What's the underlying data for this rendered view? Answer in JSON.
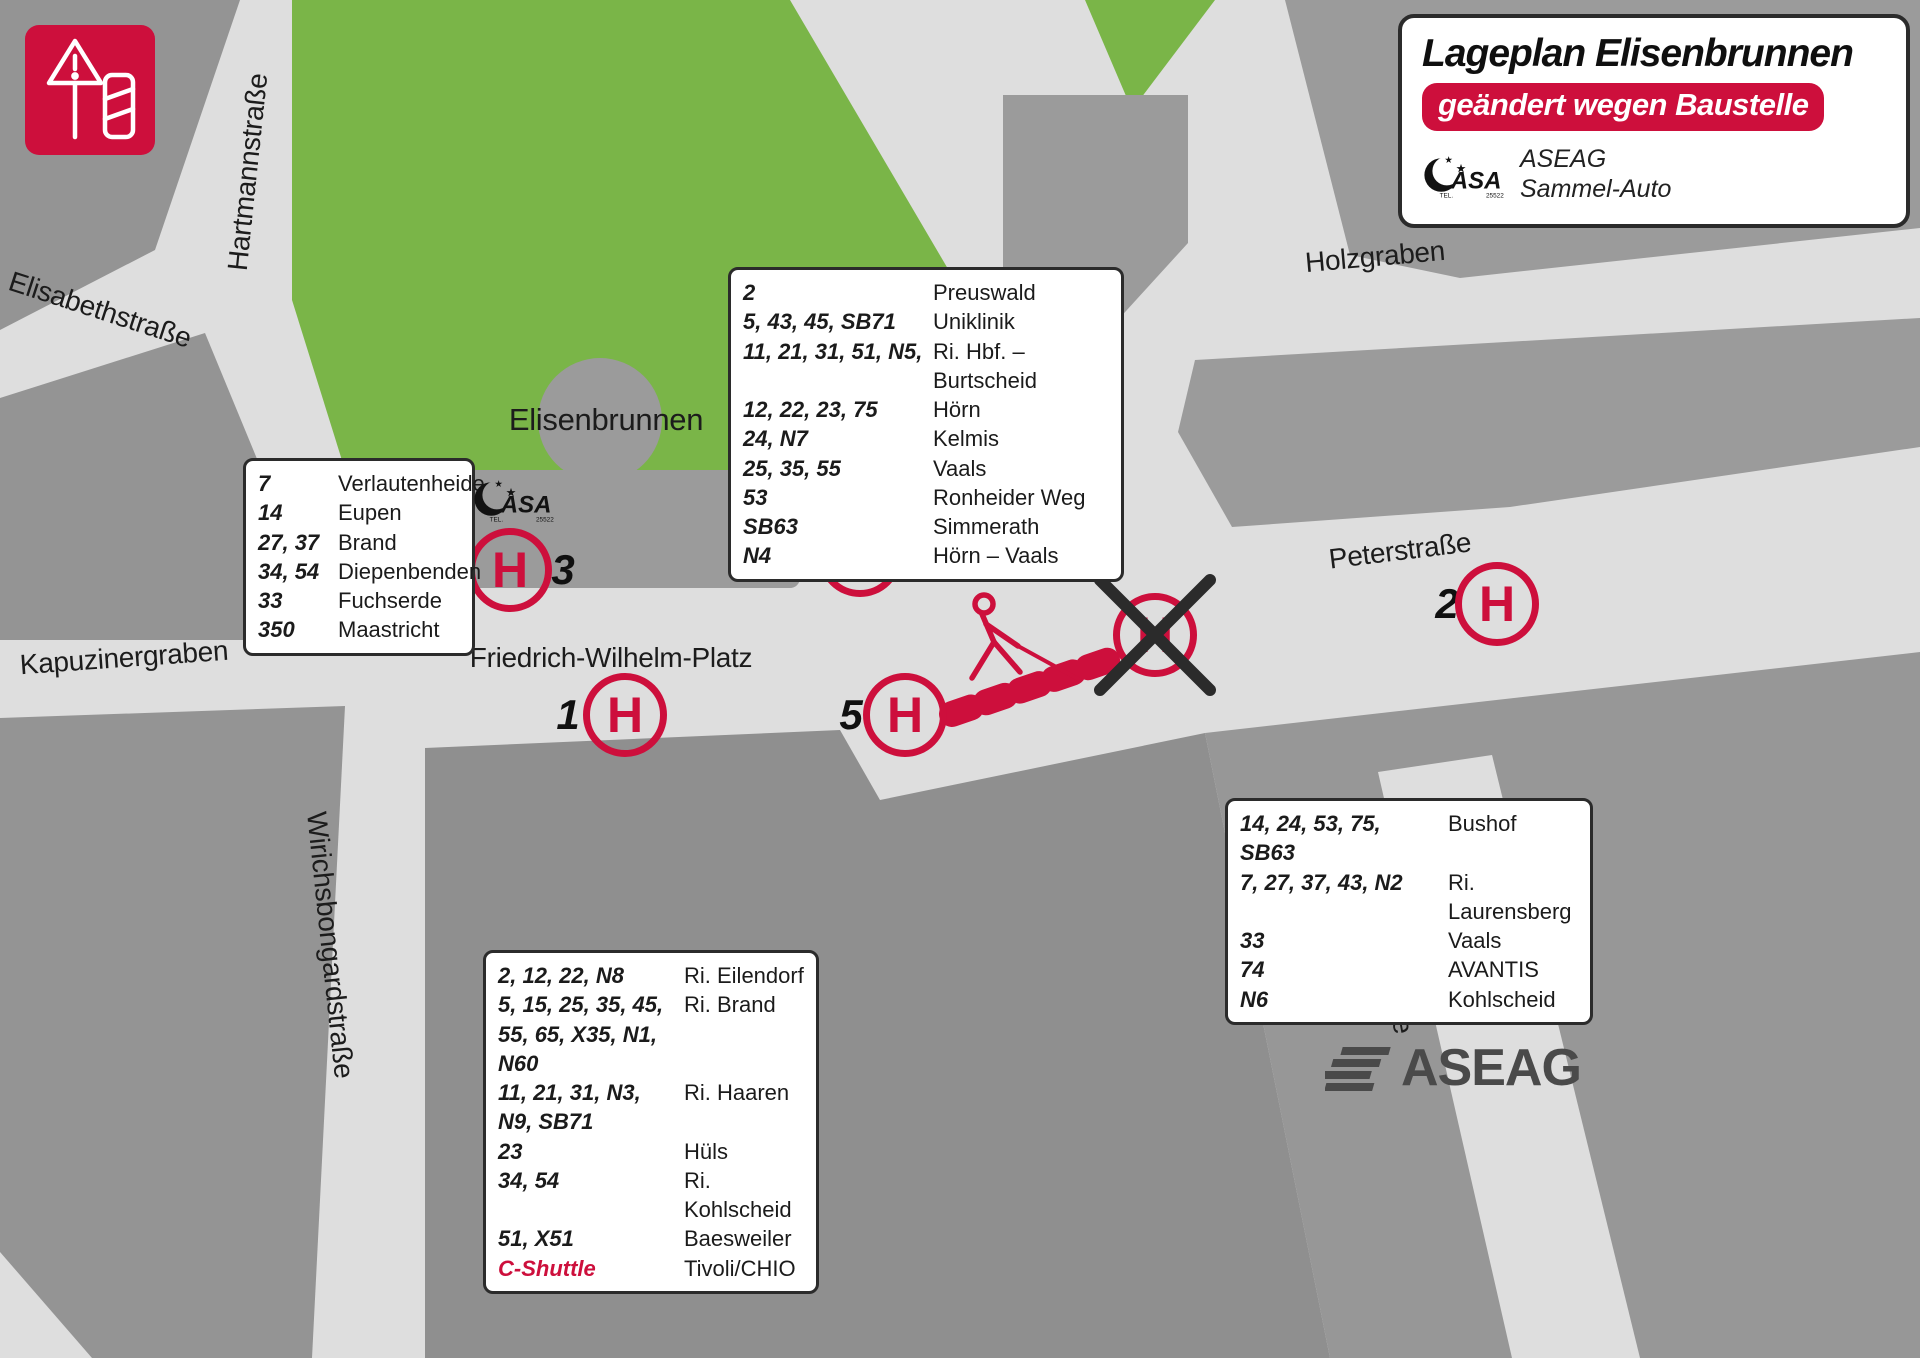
{
  "header": {
    "title": "Lageplan Elisenbrunnen",
    "badge": "geändert wegen Baustelle",
    "operator_line1": "ASEAG",
    "operator_line2": "Sammel-Auto"
  },
  "asa_logo": {
    "text": "ASA",
    "tel": "TEL.",
    "number": "25522"
  },
  "footer": {
    "brand": "ASEAG"
  },
  "map": {
    "halt_letter": "H",
    "street_labels": [
      {
        "id": "hartmannstrasse",
        "label": "Hartmannstraße"
      },
      {
        "id": "elisabethstrasse",
        "label": "Elisabethstraße"
      },
      {
        "id": "kapuzinergraben",
        "label": "Kapuzinergraben"
      },
      {
        "id": "wirichsbongardstrasse",
        "label": "Wirichsbongardstraße"
      },
      {
        "id": "friedrich-wilhelm-platz",
        "label": "Friedrich-Wilhelm-Platz"
      },
      {
        "id": "elisenbrunnen",
        "label": "Elisenbrunnen"
      },
      {
        "id": "holzgraben",
        "label": "Holzgraben"
      },
      {
        "id": "peterstrasse",
        "label": "Peterstraße"
      },
      {
        "id": "adalbertstrasse",
        "label": "Adalbertstraße"
      }
    ],
    "stops": [
      {
        "number": "1"
      },
      {
        "number": "2"
      },
      {
        "number": "3"
      },
      {
        "number": "4"
      },
      {
        "number": "5"
      }
    ]
  },
  "route_boxes": {
    "stop3": {
      "rows": [
        {
          "routes": "7",
          "destination": "Verlautenheide"
        },
        {
          "routes": "14",
          "destination": "Eupen"
        },
        {
          "routes": "27, 37",
          "destination": "Brand"
        },
        {
          "routes": "34, 54",
          "destination": "Diepenbenden"
        },
        {
          "routes": "33",
          "destination": "Fuchserde"
        },
        {
          "routes": "350",
          "destination": "Maastricht"
        }
      ]
    },
    "stop4": {
      "rows": [
        {
          "routes": "2",
          "destination": "Preuswald"
        },
        {
          "routes": "5, 43, 45, SB71",
          "destination": "Uniklinik"
        },
        {
          "routes": "11, 21, 31, 51, N5,",
          "destination": "Ri. Hbf. – Burtscheid"
        },
        {
          "routes": "12, 22, 23, 75",
          "destination": "Hörn"
        },
        {
          "routes": "24, N7",
          "destination": "Kelmis"
        },
        {
          "routes": "25, 35, 55",
          "destination": "Vaals"
        },
        {
          "routes": "53",
          "destination": "Ronheider Weg"
        },
        {
          "routes": "SB63",
          "destination": "Simmerath"
        },
        {
          "routes": "N4",
          "destination": "Hörn – Vaals"
        }
      ]
    },
    "stop1": {
      "rows": [
        {
          "routes": "2, 12, 22, N8",
          "destination": "Ri. Eilendorf"
        },
        {
          "routes": "5, 15, 25, 35, 45, 55, 65, X35, N1, N60",
          "destination": "Ri. Brand"
        },
        {
          "routes": "11, 21, 31, N3, N9, SB71",
          "destination": "Ri. Haaren"
        },
        {
          "routes": "23",
          "destination": "Hüls"
        },
        {
          "routes": "34, 54",
          "destination": "Ri. Kohlscheid"
        },
        {
          "routes": "51, X51",
          "destination": "Baesweiler"
        },
        {
          "routes": "C-Shuttle",
          "destination": "Tivoli/CHIO",
          "accent": true
        }
      ]
    },
    "stop2": {
      "rows": [
        {
          "routes": "14, 24, 53, 75, SB63",
          "destination": "Bushof"
        },
        {
          "routes": "7, 27, 37, 43, N2",
          "destination": "Ri. Laurensberg"
        },
        {
          "routes": "33",
          "destination": "Vaals"
        },
        {
          "routes": "74",
          "destination": "AVANTIS"
        },
        {
          "routes": "N6",
          "destination": "Kohlscheid"
        }
      ]
    }
  },
  "colors": {
    "accent_red": "#cd0f3c",
    "park_green": "#7ab548",
    "street_gray": "#dedede",
    "building_gray": "#9b9b9b",
    "building_dark_gray": "#8f8f8f",
    "footer_logo_gray": "#4a4a4a"
  }
}
